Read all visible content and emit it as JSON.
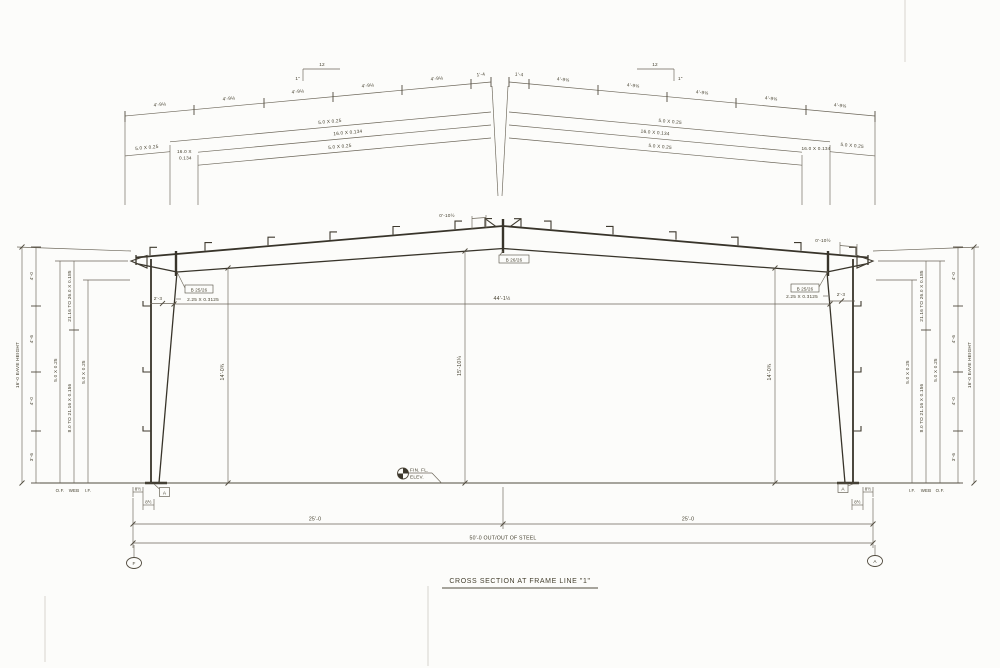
{
  "drawing": {
    "title": "CROSS SECTION AT FRAME LINE \"1\""
  },
  "rafter_detail": {
    "segment": "4'-9⅛",
    "segment_end": "1'-4",
    "slope_run": "12",
    "slope_rise": "1\"",
    "outer_flange_plate": "5.0 X 0.25",
    "web_plate": "16.0 X 0.134",
    "web_plate_line1": "16.0 X",
    "web_plate_line2": "0.134",
    "inner_flange_plate": "5.0 X 0.25",
    "end_flange_plate": "5.0 X 0.25"
  },
  "frame": {
    "clear_width": "44'-1½",
    "interior_height_left": "14'-0¾",
    "interior_height_center": "15'-10¼",
    "interior_height_right": "14'-0¾",
    "peak_offset": "0'-10½",
    "eave_offset": "0'-10½",
    "knee_width": "2'-3",
    "knee_stiffener": "2.25 X 0.3125",
    "knee_ref_left": "B 25/26",
    "peak_ref": "B 26/26",
    "knee_ref_right": "B 25/26",
    "finish_floor_line1": "FIN. FL.",
    "finish_floor_line2": "ELEV."
  },
  "column_left": {
    "eave_height": "16'-0 EAVE HEIGHT",
    "spacings": [
      "4'-0",
      "4'-6",
      "4'-0",
      "3'-6"
    ],
    "outer_flange_plate": "5.0 X 0.25",
    "web_plate_upper": "21.16 TO 26.0 X 0.185",
    "web_plate_lower": "8.0 TO 21.16 X 0.156",
    "inner_flange_plate": "5.0 X 0.25",
    "outer_flange_label": "O.F.",
    "web_label": "WEB",
    "inner_flange_label": "I.F.",
    "anchor_offset_1": "8½",
    "anchor_offset_2": "8½",
    "base_detail_ref": "A",
    "grid_bubble": "F"
  },
  "column_right": {
    "eave_height": "16'-0 EAVE HEIGHT",
    "spacings": [
      "4'-0",
      "4'-6",
      "4'-0",
      "3'-6"
    ],
    "outer_flange_plate": "5.0 X 0.25",
    "web_plate_upper": "21.16 TO 26.0 X 0.185",
    "web_plate_lower": "8.0 TO 21.16 X 0.156",
    "inner_flange_plate": "5.0 X 0.25",
    "outer_flange_label": "O.F.",
    "web_label": "WEB",
    "inner_flange_label": "I.F.",
    "anchor_offset_1": "8½",
    "anchor_offset_2": "8½",
    "base_detail_ref": "A",
    "grid_bubble": "A"
  },
  "foundation": {
    "half_span_left": "25'-0",
    "half_span_right": "25'-0",
    "overall": "50'-0 OUT/OUT OF STEEL"
  }
}
